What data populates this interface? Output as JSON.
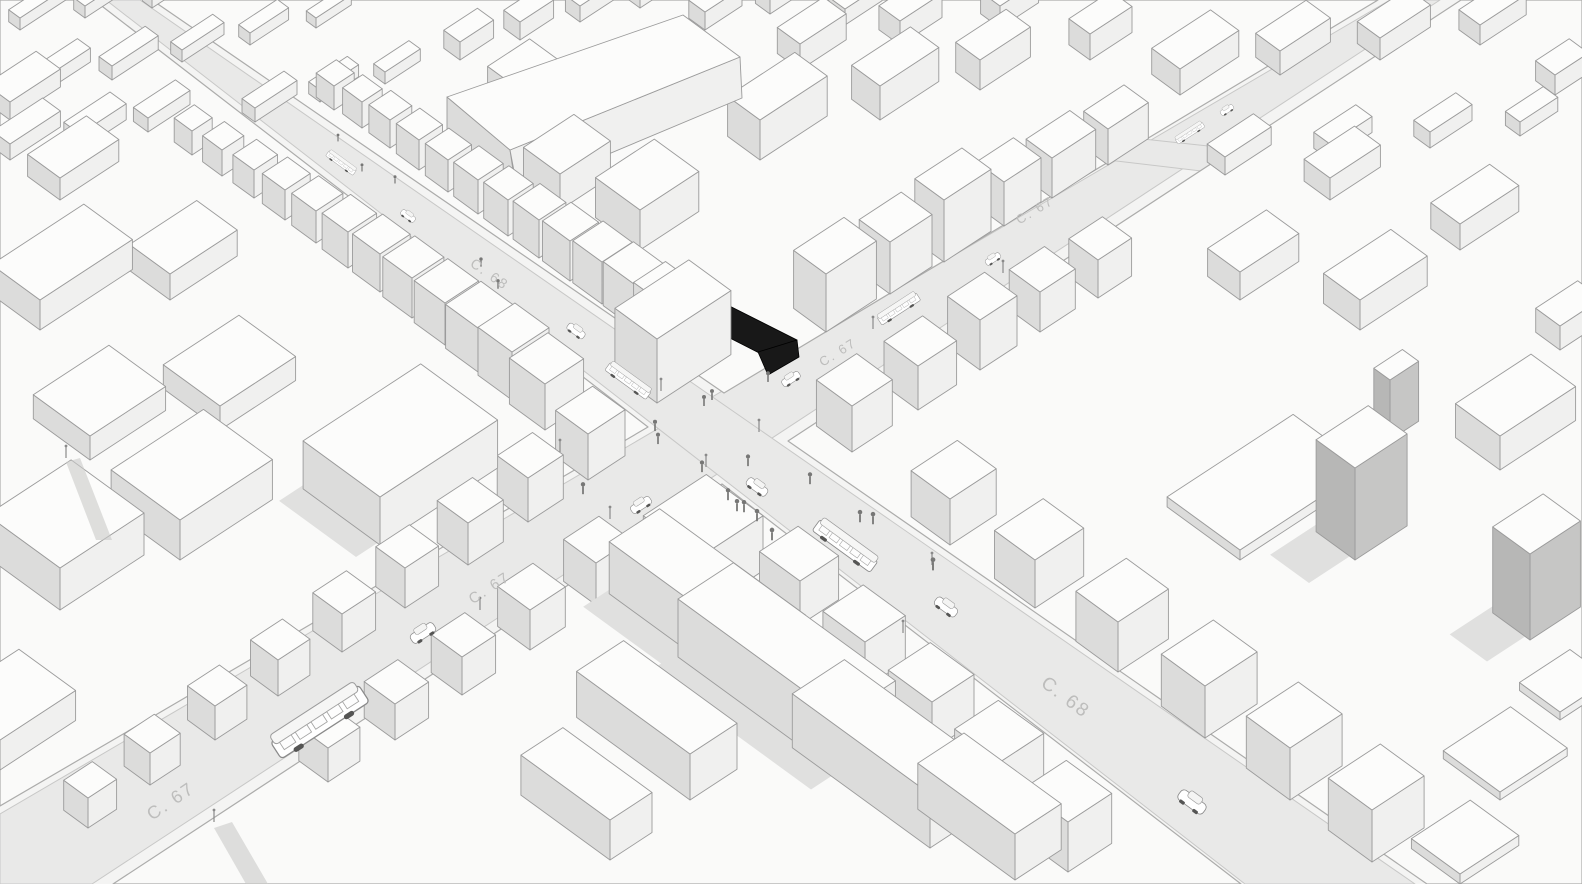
{
  "map": {
    "street_labels": [
      {
        "text": "C. 68",
        "x": 487,
        "y": 278,
        "angle": 35,
        "size": 14
      },
      {
        "text": "C. 67",
        "x": 1037,
        "y": 214,
        "angle": -31,
        "size": 13
      },
      {
        "text": "C. 67",
        "x": 840,
        "y": 356,
        "angle": -32,
        "size": 13
      },
      {
        "text": "C. 67",
        "x": 492,
        "y": 592,
        "angle": -33,
        "size": 15
      },
      {
        "text": "C. 68",
        "x": 1062,
        "y": 702,
        "angle": 37,
        "size": 19
      },
      {
        "text": "C. 67",
        "x": 174,
        "y": 806,
        "angle": -34,
        "size": 18
      }
    ],
    "highlighted_building": {
      "color": "#181818",
      "polygons": [
        "650,266 797,340 769,358 624,284",
        "621,291 624,277 651,264 667,272 660,288 646,287 638,303 624,303",
        "758,352 797,340 799,357 768,375"
      ]
    },
    "vehicles": [
      {
        "type": "bus",
        "x": 341,
        "y": 163,
        "angle": 36,
        "scale": 0.4
      },
      {
        "type": "car",
        "x": 408,
        "y": 216,
        "angle": 36,
        "scale": 0.45
      },
      {
        "type": "car",
        "x": 576,
        "y": 331,
        "angle": 36,
        "scale": 0.55
      },
      {
        "type": "bus",
        "x": 628,
        "y": 381,
        "angle": 36,
        "scale": 0.6
      },
      {
        "type": "car",
        "x": 791,
        "y": 379,
        "angle": -33,
        "scale": 0.55
      },
      {
        "type": "bus",
        "x": 899,
        "y": 309,
        "angle": -33,
        "scale": 0.55
      },
      {
        "type": "car",
        "x": 993,
        "y": 259,
        "angle": -33,
        "scale": 0.46
      },
      {
        "type": "bus",
        "x": 1190,
        "y": 133,
        "angle": -33,
        "scale": 0.38
      },
      {
        "type": "car",
        "x": 1227,
        "y": 110,
        "angle": -33,
        "scale": 0.4
      },
      {
        "type": "car",
        "x": 757,
        "y": 487,
        "angle": 36,
        "scale": 0.65
      },
      {
        "type": "car",
        "x": 641,
        "y": 505,
        "angle": -33,
        "scale": 0.62
      },
      {
        "type": "bus",
        "x": 845,
        "y": 546,
        "angle": 36,
        "scale": 0.85
      },
      {
        "type": "car",
        "x": 946,
        "y": 607,
        "angle": 36,
        "scale": 0.7
      },
      {
        "type": "car",
        "x": 423,
        "y": 633,
        "angle": -33,
        "scale": 0.75
      },
      {
        "type": "bus",
        "x": 320,
        "y": 722,
        "angle": -33,
        "scale": 1.25
      },
      {
        "type": "car",
        "x": 1192,
        "y": 802,
        "angle": 36,
        "scale": 0.85
      }
    ],
    "pedestrians": [
      [
        712,
        398
      ],
      [
        704,
        404
      ],
      [
        748,
        464
      ],
      [
        737,
        509
      ],
      [
        757,
        519
      ],
      [
        702,
        470
      ],
      [
        860,
        520
      ],
      [
        583,
        492
      ],
      [
        768,
        380
      ],
      [
        655,
        429
      ],
      [
        658,
        442
      ],
      [
        728,
        498
      ],
      [
        744,
        510
      ],
      [
        772,
        538
      ],
      [
        810,
        482
      ],
      [
        873,
        522
      ],
      [
        933,
        568
      ],
      [
        338,
        140
      ],
      [
        362,
        170
      ],
      [
        395,
        182
      ],
      [
        481,
        265
      ],
      [
        498,
        287
      ]
    ],
    "street_lights": [
      [
        661,
        391
      ],
      [
        706,
        467
      ],
      [
        759,
        432
      ],
      [
        873,
        329
      ],
      [
        1003,
        273
      ],
      [
        560,
        452
      ],
      [
        610,
        519
      ],
      [
        903,
        633
      ],
      [
        480,
        610
      ],
      [
        214,
        822
      ],
      [
        66,
        458
      ],
      [
        932,
        565
      ]
    ],
    "colors": {
      "background": "#f4f4f3",
      "road": "#e9e9e8",
      "road_edge": "#c8c8c7",
      "block": "#fafaf9",
      "block_edge": "#acacab",
      "building_top": "#fcfcfb",
      "building_front": "#f0f0ef",
      "building_side": "#dcdcdb",
      "building_front_dark": "#c6c6c5",
      "building_side_dark": "#b7b7b6",
      "outline": "#9b9b9b",
      "shadow": "#e0e0df",
      "label": "#bdbdbc",
      "highlight": "#181818",
      "vehicle_body": "#ffffff",
      "vehicle_line": "#8a8a8a",
      "figure": "#777776"
    }
  }
}
